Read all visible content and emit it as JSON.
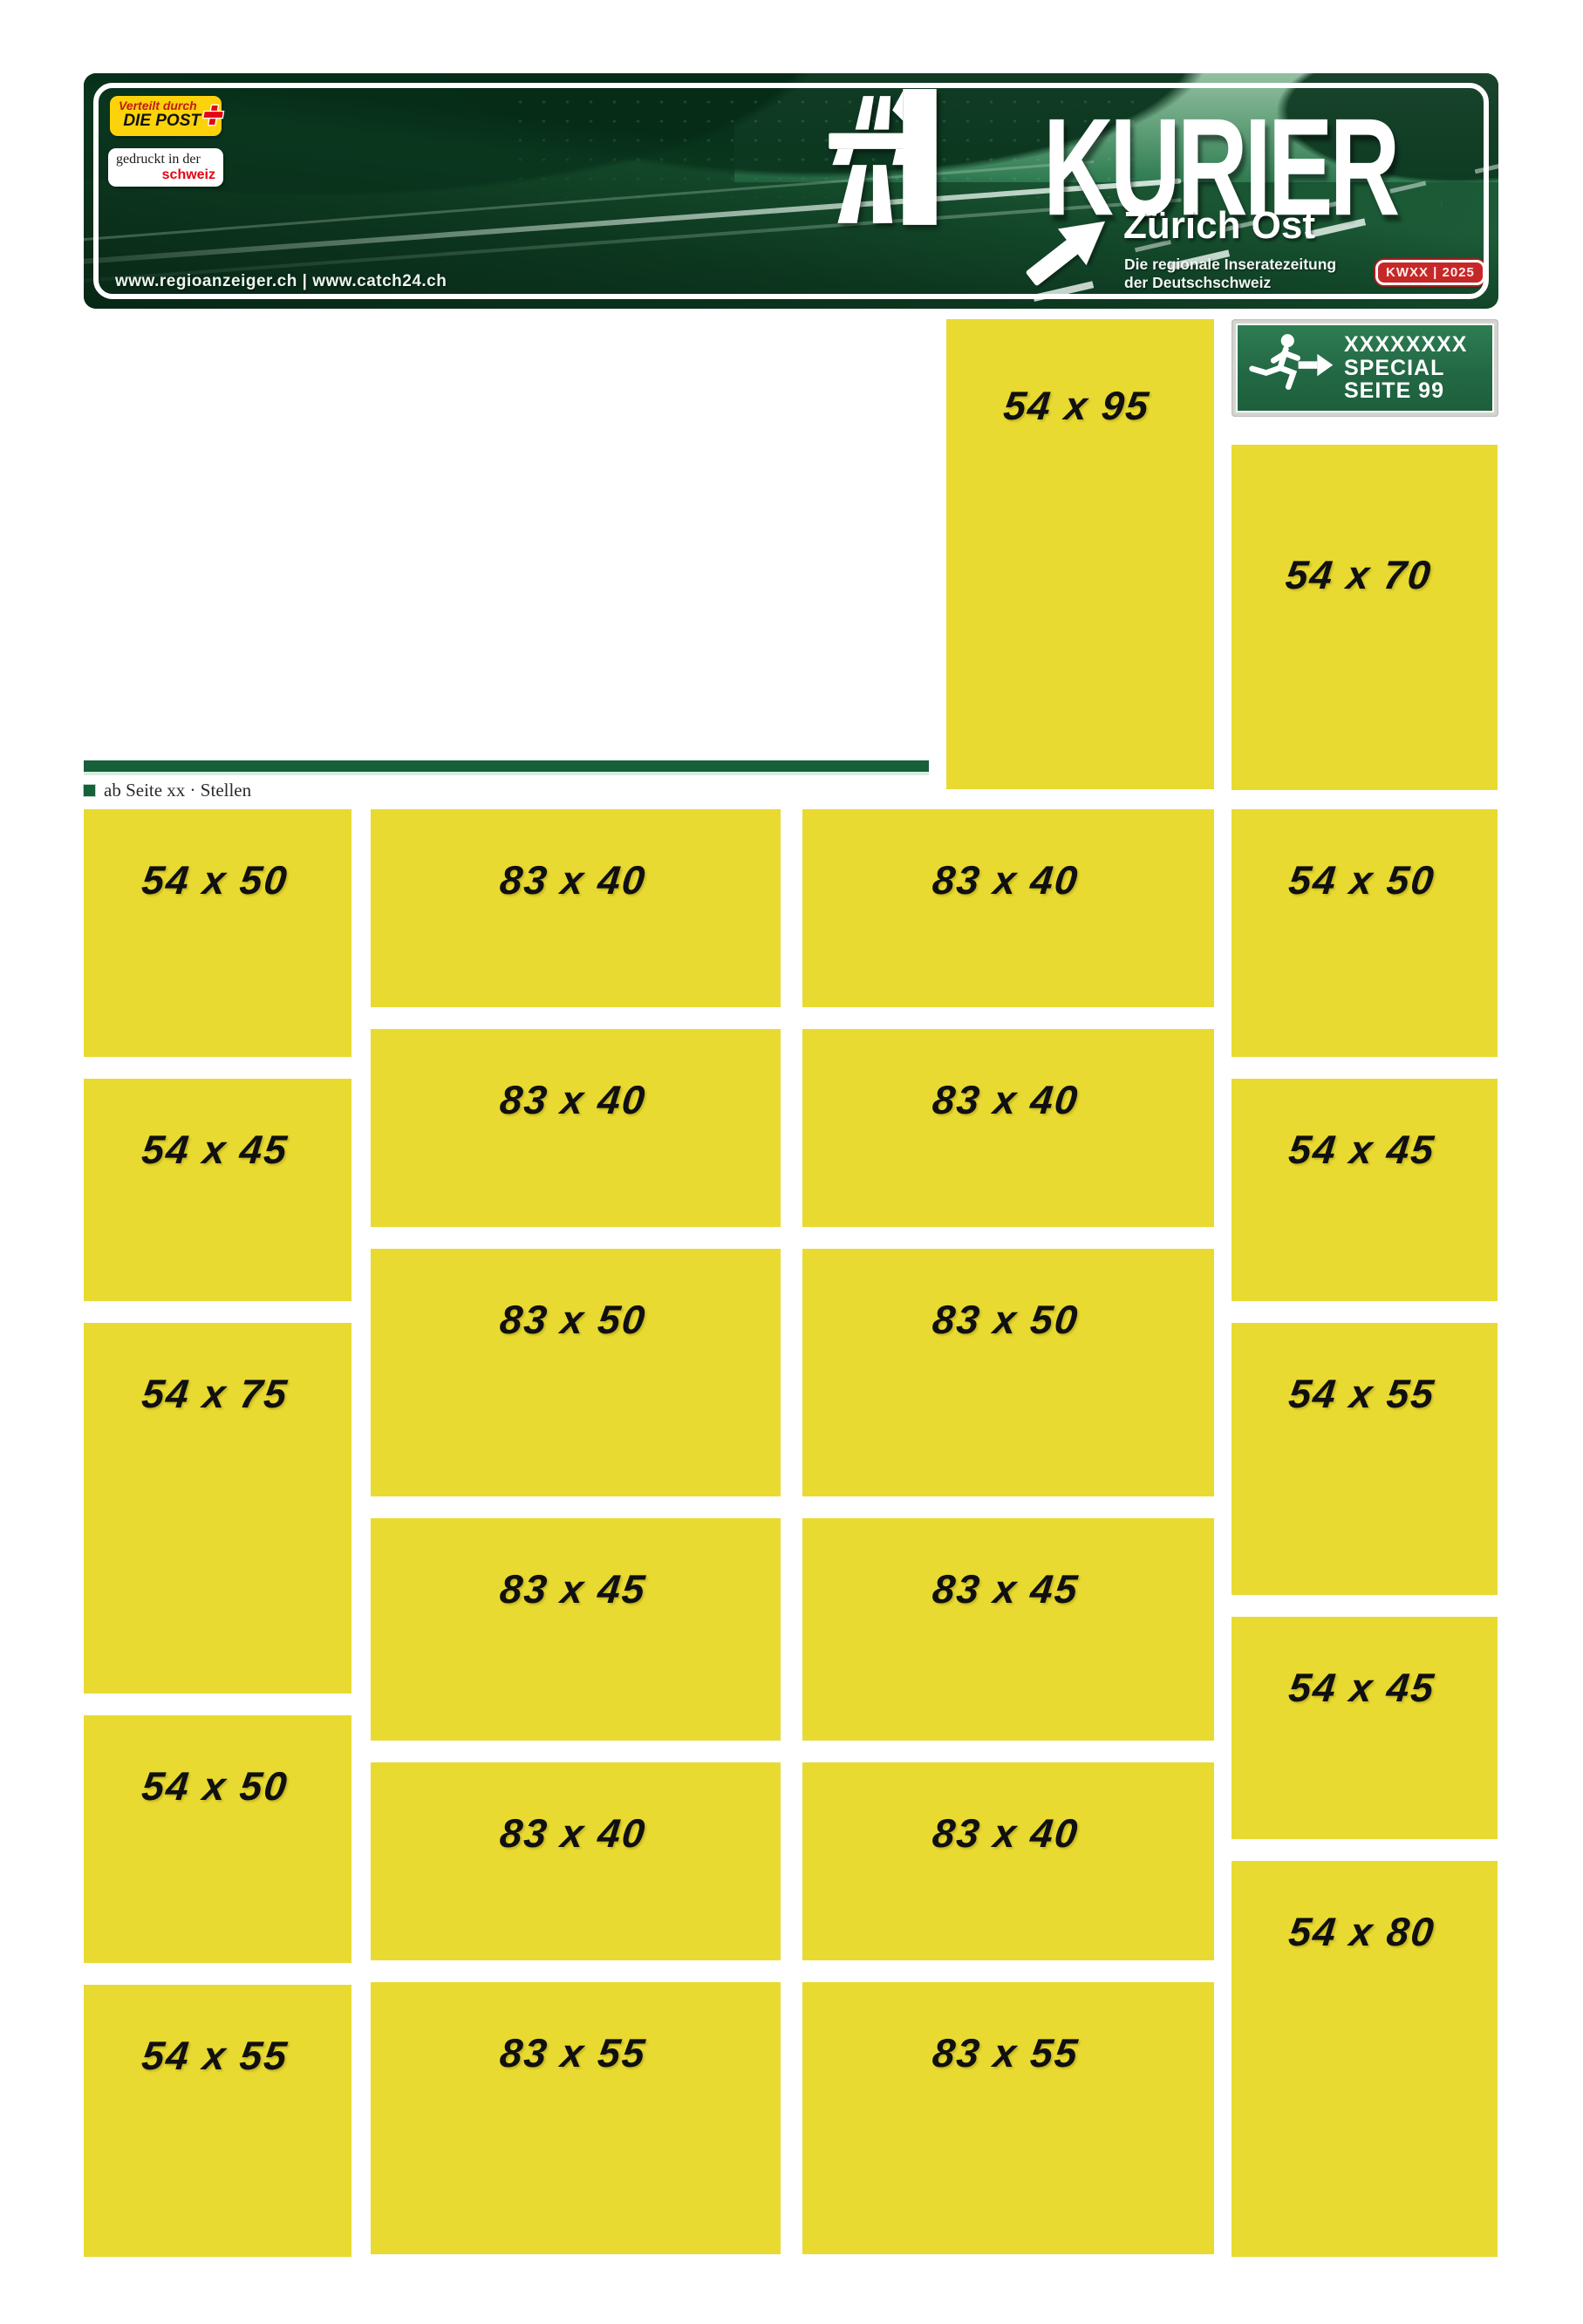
{
  "banner": {
    "masthead": "KURIER",
    "region": "Zürich Ost",
    "tagline": [
      "Die regionale Inseratezeitung",
      "der Deutschschweiz"
    ],
    "week_badge": "KWXX | 2025",
    "urls": "www.regioanzeiger.ch | www.catch24.ch",
    "distribution_badge": {
      "line1": "Verteilt durch",
      "line2": "DIE POST"
    },
    "printed_badge": {
      "line1": "gedruckt in der",
      "line2": "schweiz"
    }
  },
  "exit_sign": {
    "line1": "XXXXXXXX",
    "line2": "SPECIAL",
    "line3": "SEITE 99"
  },
  "section_label": "ab Seite xx · Stellen",
  "ad_slots": {
    "featured": [
      {
        "label": "54 x 95",
        "w_mm": 54,
        "h_mm": 95
      },
      {
        "label": "54 x 70",
        "w_mm": 54,
        "h_mm": 70
      }
    ],
    "col1": [
      {
        "label": "54 x 50",
        "w_mm": 54,
        "h_mm": 50
      },
      {
        "label": "54 x 45",
        "w_mm": 54,
        "h_mm": 45
      },
      {
        "label": "54 x 75",
        "w_mm": 54,
        "h_mm": 75
      },
      {
        "label": "54 x 50",
        "w_mm": 54,
        "h_mm": 50
      },
      {
        "label": "54 x 55",
        "w_mm": 54,
        "h_mm": 55
      }
    ],
    "col2": [
      {
        "label": "83 x 40",
        "w_mm": 83,
        "h_mm": 40
      },
      {
        "label": "83 x 40",
        "w_mm": 83,
        "h_mm": 40
      },
      {
        "label": "83 x 50",
        "w_mm": 83,
        "h_mm": 50
      },
      {
        "label": "83 x 45",
        "w_mm": 83,
        "h_mm": 45
      },
      {
        "label": "83 x 40",
        "w_mm": 83,
        "h_mm": 40
      },
      {
        "label": "83 x 55",
        "w_mm": 83,
        "h_mm": 55
      }
    ],
    "col3": [
      {
        "label": "83 x 40",
        "w_mm": 83,
        "h_mm": 40
      },
      {
        "label": "83 x 40",
        "w_mm": 83,
        "h_mm": 40
      },
      {
        "label": "83 x 50",
        "w_mm": 83,
        "h_mm": 50
      },
      {
        "label": "83 x 45",
        "w_mm": 83,
        "h_mm": 45
      },
      {
        "label": "83 x 40",
        "w_mm": 83,
        "h_mm": 40
      },
      {
        "label": "83 x 55",
        "w_mm": 83,
        "h_mm": 55
      }
    ],
    "col4": [
      {
        "label": "54 x 50",
        "w_mm": 54,
        "h_mm": 50
      },
      {
        "label": "54 x 45",
        "w_mm": 54,
        "h_mm": 45
      },
      {
        "label": "54 x 55",
        "w_mm": 54,
        "h_mm": 55
      },
      {
        "label": "54 x 45",
        "w_mm": 54,
        "h_mm": 45
      },
      {
        "label": "54 x 80",
        "w_mm": 54,
        "h_mm": 80
      }
    ]
  },
  "colors": {
    "slot_yellow": "#E9DA31",
    "banner_green_dark": "#0E4526",
    "banner_green_mid": "#1E6340",
    "sign_green": "#256F47",
    "bar_green": "#17603A",
    "post_red": "#E30613",
    "badge_yellow": "#FCD20A",
    "week_badge_red": "#C62828"
  }
}
